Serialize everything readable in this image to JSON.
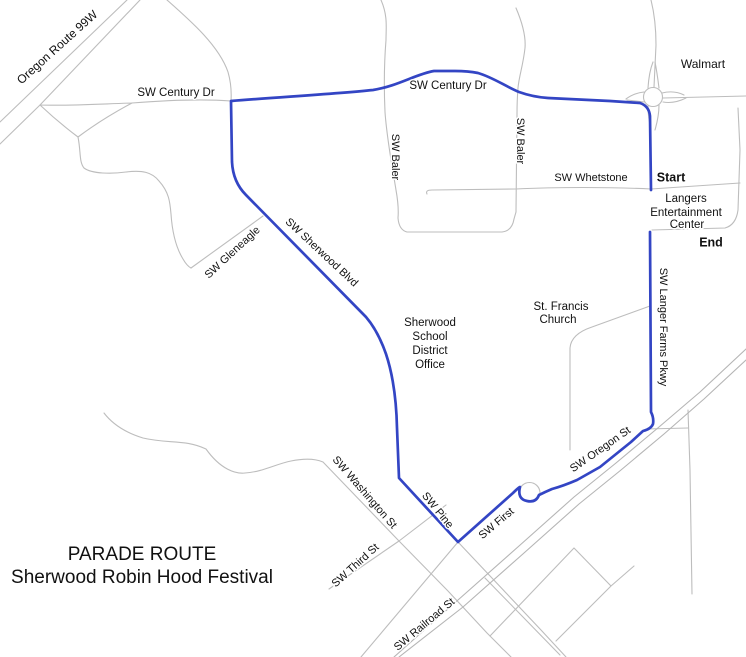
{
  "map": {
    "colors": {
      "route": "#3345c4",
      "road": "#bdbdbd",
      "rail": "#b5b5b5",
      "text": "#111111",
      "halo": "#ffffff"
    },
    "title": {
      "line1": "PARADE ROUTE",
      "line2": "Sherwood Robin Hood Festival"
    },
    "markers": {
      "start": "Start",
      "end": "End"
    },
    "labels": {
      "oregon_99w": "Oregon Route 99W",
      "century_west": "SW Century Dr",
      "century_east": "SW Century Dr",
      "baler_west": "SW Baler",
      "baler_east": "SW Baler",
      "whetstone": "SW Whetstone",
      "langer_farms": "SW Langer Farms Pkwy",
      "gleneagle": "SW Gleneagle",
      "sherwood_blvd": "SW Sherwood Blvd",
      "oregon_st": "SW Oregon St",
      "washington": "SW Washington St",
      "pine": "SW Pine",
      "first": "SW First",
      "third": "SW Third St",
      "railroad": "SW Railroad St"
    },
    "places": {
      "walmart": "Walmart",
      "langers_line1": "Langers",
      "langers_line2": "Entertainment",
      "langers_line3": "Center",
      "school_line1": "Sherwood",
      "school_line2": "School",
      "school_line3": "District",
      "school_line4": "Office",
      "church_line1": "St. Francis",
      "church_line2": "Church"
    }
  }
}
